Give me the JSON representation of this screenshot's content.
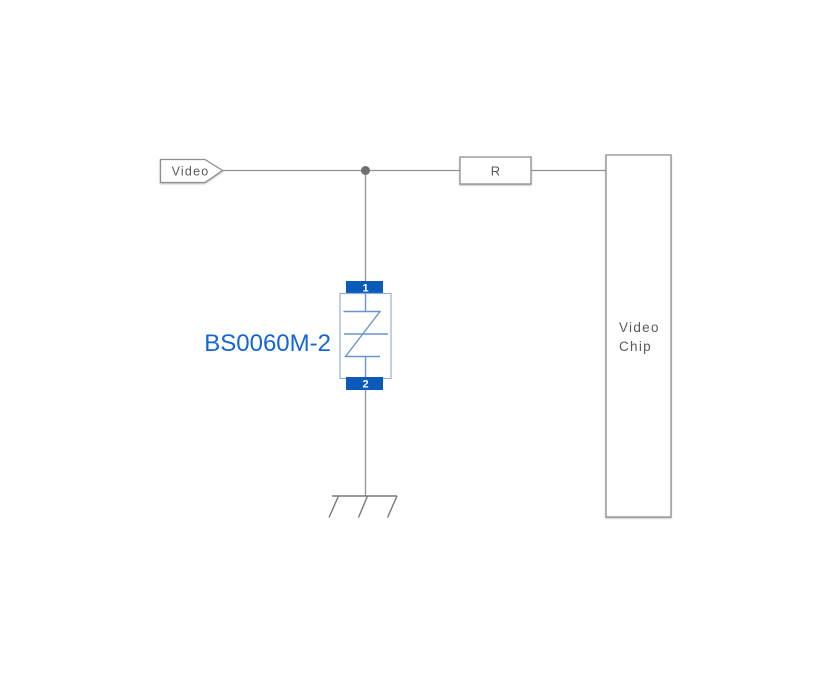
{
  "diagram": {
    "type": "circuit-schematic",
    "colors": {
      "background": "#ffffff",
      "wire": "#949494",
      "box_border": "#8f8f8f",
      "text_gray": "#595959",
      "junction_dot": "#6f6f6f",
      "pin_fill": "#0c59bc",
      "pin_text": "#ffffff",
      "tvs_body_border": "#8fb0dd",
      "tvs_symbol": "#6a94cf",
      "part_label": "#1565d2",
      "ground": "#787878"
    },
    "video_port": {
      "label": "Video"
    },
    "resistor": {
      "label": "R"
    },
    "video_chip": {
      "line1": "Video",
      "line2": "Chip"
    },
    "tvs": {
      "part_number": "BS0060M-2",
      "pin_top": "1",
      "pin_bottom": "2"
    },
    "ground": {
      "style": "chassis-ground"
    },
    "connections": [
      "Video port to junction",
      "Junction to resistor R",
      "Resistor R to Video Chip",
      "Junction down to TVS pin 1",
      "TVS pin 2 to chassis ground"
    ]
  }
}
